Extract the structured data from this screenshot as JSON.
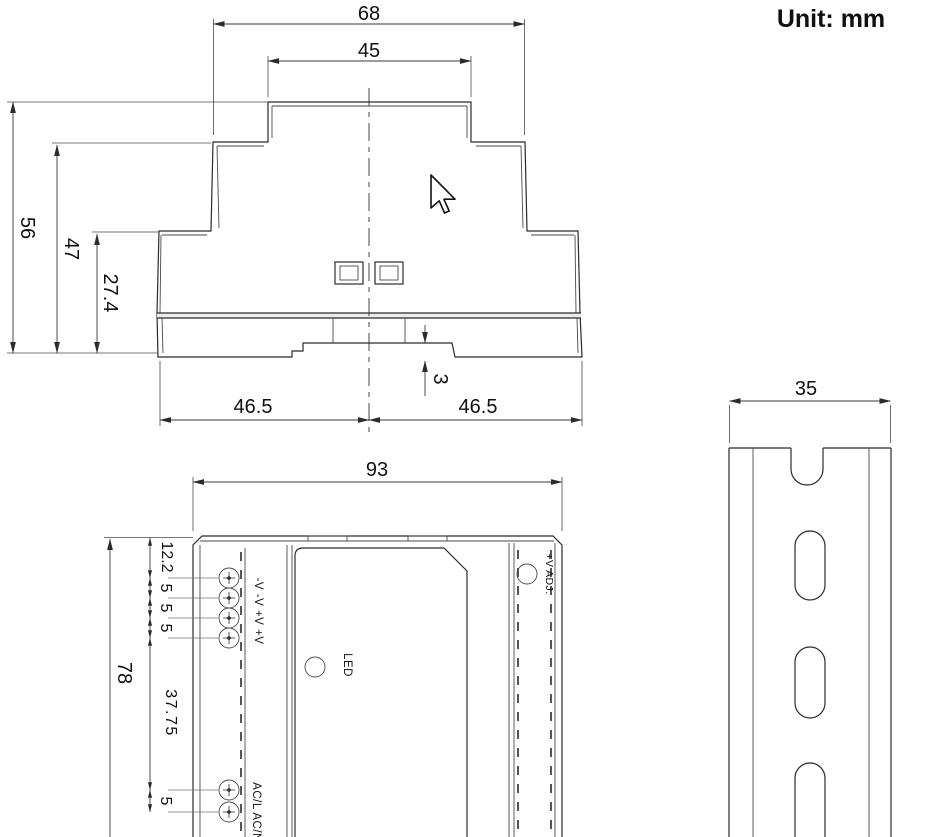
{
  "title": {
    "unit_label": "Unit: mm"
  },
  "side_view": {
    "dims": {
      "overall_width": "68",
      "top_width": "45",
      "total_height": "56",
      "shoulder_height": "47",
      "body_height": "27.4",
      "rail_recess_depth": "3",
      "half_width_left": "46.5",
      "half_width_right": "46.5"
    }
  },
  "front_view": {
    "dims": {
      "overall_width": "93",
      "overall_height": "78",
      "terminal_offset_top": "12.2",
      "terminal_pitch_1": "5",
      "terminal_pitch_2": "5",
      "terminal_pitch_3": "5",
      "terminal_gap": "37.75",
      "ac_terminal_pitch": "5"
    },
    "labels": {
      "dc_terminals": "-V -V +V +V",
      "ac_terminals": "AC/L AC/N",
      "led": "LED",
      "voltage_adjust": "+V ADJ."
    }
  },
  "din_rail_view": {
    "dims": {
      "rail_width": "35"
    }
  }
}
